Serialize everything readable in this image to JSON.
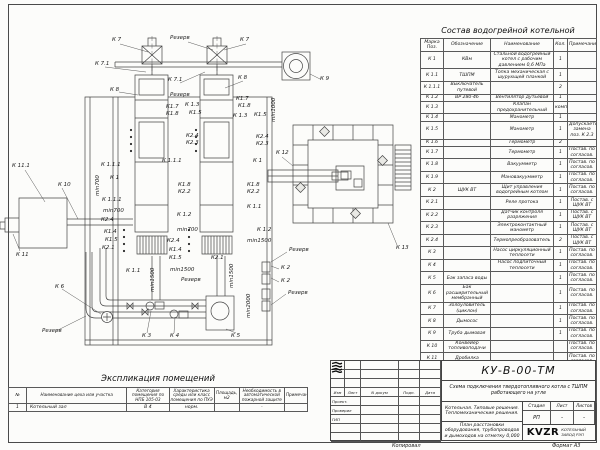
{
  "sheet": {
    "copied_label": "Копировал",
    "format_label": "Формат А3"
  },
  "parts_table": {
    "title": "Состав водогрейной котельной",
    "headers": [
      "Марка Поз.",
      "Обозначение",
      "Наименование",
      "Кол.",
      "Примечание"
    ],
    "rows": [
      {
        "mark": "К 1",
        "code": "КВм",
        "name": "Стальной водогрейный котел с рабочим давлением 0,6 МПа",
        "qty": "1",
        "note": ""
      },
      {
        "mark": "К 1.1",
        "code": "ТШПМ",
        "name": "Топка механическая с шурующей планкой",
        "qty": "1",
        "note": ""
      },
      {
        "mark": "К 1.1.1",
        "code": "Выключатель путевой",
        "name": "",
        "qty": "2",
        "note": ""
      },
      {
        "mark": "К 1.2",
        "code": "ВР 280-46",
        "name": "Вентилятор дутьевой",
        "qty": "1",
        "note": ""
      },
      {
        "mark": "К 1.3",
        "code": "",
        "name": "Клапан предохранительный",
        "qty": "компл",
        "note": ""
      },
      {
        "mark": "К 1.4",
        "code": "",
        "name": "Манометр",
        "qty": "1",
        "note": ""
      },
      {
        "mark": "К 1.5",
        "code": "",
        "name": "Манометр",
        "qty": "1",
        "note": "Допускается замена поз. К 2.3"
      },
      {
        "mark": "К 1.6",
        "code": "",
        "name": "Термометр",
        "qty": "2",
        "note": ""
      },
      {
        "mark": "К 1.7",
        "code": "",
        "name": "Термометр",
        "qty": "1",
        "note": "Постав. по согласов."
      },
      {
        "mark": "К 1.8",
        "code": "",
        "name": "Вакуумметр",
        "qty": "1",
        "note": "Постав. по согласов."
      },
      {
        "mark": "К 1.9",
        "code": "",
        "name": "Мановакуумметр",
        "qty": "1",
        "note": "Постав. по согласов."
      },
      {
        "mark": "К 2",
        "code": "ЩУК ВТ",
        "name": "Щит управления водогрейным котлом",
        "qty": "1",
        "note": "Постав. по согласов."
      },
      {
        "mark": "К 2.1",
        "code": "",
        "name": "Реле протока",
        "qty": "1",
        "note": "Постав. с ЩУК ВТ"
      },
      {
        "mark": "К 2.2",
        "code": "",
        "name": "Датчик контроля разряжения",
        "qty": "1",
        "note": "Постав. с ЩУК ВТ"
      },
      {
        "mark": "К 2.3",
        "code": "",
        "name": "Электроконтактный манометр",
        "qty": "1",
        "note": "Постав. с ЩУК ВТ"
      },
      {
        "mark": "К 2.4",
        "code": "",
        "name": "Термопреобразователь",
        "qty": "2",
        "note": "Постав. с ЩУК ВТ"
      },
      {
        "mark": "К 3",
        "code": "",
        "name": "Насос циркуляционный теплосети",
        "qty": "1",
        "note": "Постав. по согласов."
      },
      {
        "mark": "К 4",
        "code": "",
        "name": "Насос подпиточный теплосети",
        "qty": "1",
        "note": "Постав. по согласов."
      },
      {
        "mark": "К 5",
        "code": "Бак запаса воды",
        "name": "",
        "qty": "1",
        "note": "Постав. по согласов."
      },
      {
        "mark": "К 6",
        "code": "Бак расширительный мембранный",
        "name": "",
        "qty": "1",
        "note": "Постав. по согласов."
      },
      {
        "mark": "К 7",
        "code": "Золоуловитель (циклон)",
        "name": "",
        "qty": "1",
        "note": "Постав. по согласов."
      },
      {
        "mark": "К 8",
        "code": "Дымосос",
        "name": "",
        "qty": "1",
        "note": "Постав. по согласов."
      },
      {
        "mark": "К 9",
        "code": "Труба дымовая",
        "name": "",
        "qty": "1",
        "note": "Постав. по согласов."
      },
      {
        "mark": "К 10",
        "code": "Конвейер топливоподачи",
        "name": "",
        "qty": "",
        "note": "Постав. по согласов."
      },
      {
        "mark": "К 11",
        "code": "Дробилка",
        "name": "",
        "qty": "",
        "note": "Постав. по согласов."
      },
      {
        "mark": "К 11.1",
        "code": "Бункер угля",
        "name": "",
        "qty": "",
        "note": "Постав. по согласов."
      },
      {
        "mark": "К 12",
        "code": "Конвейер ШЗУ",
        "name": "",
        "qty": "",
        "note": "Постав. по согласов."
      },
      {
        "mark": "К 13",
        "code": "Бункер шлакоприемник",
        "name": "",
        "qty": "",
        "note": "Постав. по согласов."
      }
    ]
  },
  "rooms_table": {
    "title": "Экспликация помещений",
    "headers": [
      "№",
      "Наименование цеха или участка",
      "Категория помещения по НПБ 105-03",
      "Характеристика среды или класс помещения по ПУЭ",
      "Площадь, м2",
      "Необходимость в автоматической пожарной защите",
      "Примечание"
    ],
    "rows": [
      {
        "num": "1",
        "name": "Котельный зал",
        "cat": "В 4",
        "env": "норм.",
        "area": "",
        "fire": "-",
        "note": ""
      }
    ]
  },
  "title_block": {
    "doc_number": "КУ-В-00-ТМ",
    "doc_title": "Схема подключения твердотопливного котла с ТШПМ работающего на угле",
    "project_name": "Котельная. Типовые решения. Тепломеханические решения.",
    "sheet_title": "План расстановки оборудования, трубопроводов и дымоходов на отметку 0,000",
    "columns": [
      "Изм",
      "Лист",
      "N докум",
      "Подп.",
      "Дата"
    ],
    "roles": [
      "Проект.",
      "Проверил",
      "ГИП"
    ],
    "stage_label": "Стадия",
    "sheet_label": "Лист",
    "sheets_label": "Листов",
    "stage": "РП",
    "sheet": "-",
    "sheets": "-",
    "logo_text": "KVZR",
    "logo_caption": "КОТЕЛЬНЫЙ ЗАВОД РЭП"
  },
  "drawing": {
    "labels": [
      {
        "text": "К 7",
        "x": 112,
        "y": 38
      },
      {
        "text": "Резерв",
        "x": 170,
        "y": 36
      },
      {
        "text": "К 7",
        "x": 240,
        "y": 38
      },
      {
        "text": "К 7.1",
        "x": 95,
        "y": 62
      },
      {
        "text": "К 7.1",
        "x": 168,
        "y": 78
      },
      {
        "text": "К 8",
        "x": 238,
        "y": 76
      },
      {
        "text": "К 8",
        "x": 110,
        "y": 88
      },
      {
        "text": "Резерв",
        "x": 170,
        "y": 93
      },
      {
        "text": "К 9",
        "x": 320,
        "y": 77
      },
      {
        "text": "К1.7",
        "x": 166,
        "y": 105
      },
      {
        "text": "К1.8",
        "x": 166,
        "y": 112
      },
      {
        "text": "К 1.3",
        "x": 185,
        "y": 103
      },
      {
        "text": "К1.5",
        "x": 189,
        "y": 111
      },
      {
        "text": "К1.7",
        "x": 236,
        "y": 97
      },
      {
        "text": "К1.8",
        "x": 238,
        "y": 104
      },
      {
        "text": "К 1.3",
        "x": 233,
        "y": 114
      },
      {
        "text": "К1.5",
        "x": 254,
        "y": 113
      },
      {
        "text": "min1000",
        "x": 272,
        "y": 122,
        "rot": true
      },
      {
        "text": "К2.4",
        "x": 186,
        "y": 134
      },
      {
        "text": "К2.3",
        "x": 186,
        "y": 141
      },
      {
        "text": "К2.4",
        "x": 256,
        "y": 135
      },
      {
        "text": "К2.3",
        "x": 256,
        "y": 142
      },
      {
        "text": "К 12",
        "x": 276,
        "y": 151
      },
      {
        "text": "К 1.1.1",
        "x": 162,
        "y": 159
      },
      {
        "text": "К 1",
        "x": 253,
        "y": 159
      },
      {
        "text": "К 11.1",
        "x": 12,
        "y": 164
      },
      {
        "text": "К 1.1.1",
        "x": 101,
        "y": 163
      },
      {
        "text": "min700",
        "x": 96,
        "y": 196,
        "rot": true
      },
      {
        "text": "К 1",
        "x": 110,
        "y": 176
      },
      {
        "text": "К 10",
        "x": 58,
        "y": 183
      },
      {
        "text": "К1.8",
        "x": 178,
        "y": 183
      },
      {
        "text": "К2.2",
        "x": 178,
        "y": 190
      },
      {
        "text": "К1.8",
        "x": 247,
        "y": 183
      },
      {
        "text": "К2.2",
        "x": 247,
        "y": 190
      },
      {
        "text": "К 1.1.1",
        "x": 102,
        "y": 198
      },
      {
        "text": "min700",
        "x": 103,
        "y": 209
      },
      {
        "text": "К 1.1",
        "x": 247,
        "y": 205
      },
      {
        "text": "К 1.2",
        "x": 177,
        "y": 213
      },
      {
        "text": "К2.4",
        "x": 101,
        "y": 218
      },
      {
        "text": "min700",
        "x": 177,
        "y": 228
      },
      {
        "text": "К 1.2",
        "x": 257,
        "y": 228
      },
      {
        "text": "К1.4",
        "x": 104,
        "y": 230
      },
      {
        "text": "К1.5",
        "x": 105,
        "y": 238
      },
      {
        "text": "min1500",
        "x": 247,
        "y": 239
      },
      {
        "text": "К2.4",
        "x": 167,
        "y": 239
      },
      {
        "text": "К2.1",
        "x": 102,
        "y": 246
      },
      {
        "text": "К 13",
        "x": 396,
        "y": 246
      },
      {
        "text": "Резерв",
        "x": 289,
        "y": 248
      },
      {
        "text": "К1.4",
        "x": 169,
        "y": 248
      },
      {
        "text": "К 11",
        "x": 16,
        "y": 253
      },
      {
        "text": "К1.5",
        "x": 169,
        "y": 256
      },
      {
        "text": "К2.1",
        "x": 211,
        "y": 256
      },
      {
        "text": "К 2",
        "x": 281,
        "y": 266
      },
      {
        "text": "К 1.1",
        "x": 126,
        "y": 269
      },
      {
        "text": "min1500",
        "x": 151,
        "y": 292,
        "rot": true
      },
      {
        "text": "min1500",
        "x": 170,
        "y": 268
      },
      {
        "text": "min1500",
        "x": 230,
        "y": 288,
        "rot": true
      },
      {
        "text": "Резерв",
        "x": 181,
        "y": 278
      },
      {
        "text": "К 2",
        "x": 281,
        "y": 279
      },
      {
        "text": "К 6",
        "x": 55,
        "y": 285
      },
      {
        "text": "Резерв",
        "x": 288,
        "y": 291
      },
      {
        "text": "min2000",
        "x": 247,
        "y": 318,
        "rot": true
      },
      {
        "text": "Резерв",
        "x": 42,
        "y": 329
      },
      {
        "text": "К 3",
        "x": 142,
        "y": 334
      },
      {
        "text": "К 4",
        "x": 170,
        "y": 334
      },
      {
        "text": "К 5",
        "x": 231,
        "y": 334
      }
    ]
  }
}
